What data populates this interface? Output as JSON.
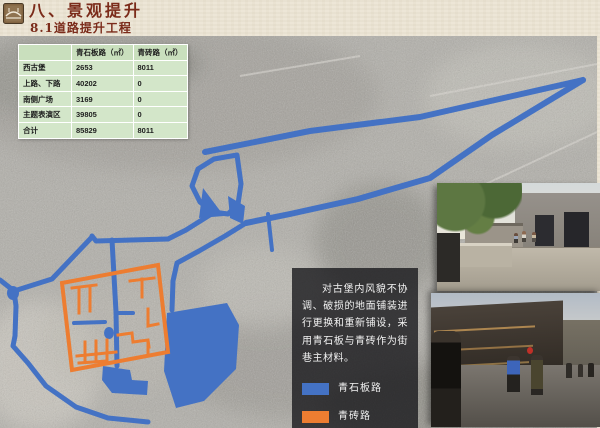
{
  "header": {
    "title": "八、景观提升",
    "subtitle": "8.1道路提升工程"
  },
  "table": {
    "col_headers": [
      "",
      "青石板路（㎡）",
      "青砖路（㎡）"
    ],
    "rows": [
      {
        "label": "西古堡",
        "stone": "2653",
        "brick": "8011"
      },
      {
        "label": "上路、下路",
        "stone": "40202",
        "brick": "0"
      },
      {
        "label": "南侧广场",
        "stone": "3169",
        "brick": "0"
      },
      {
        "label": "主题表演区",
        "stone": "39805",
        "brick": "0"
      },
      {
        "label": "合计",
        "stone": "85829",
        "brick": "8011"
      }
    ]
  },
  "note": {
    "text": "对古堡内风貌不协调、破损的地面铺装进行更换和重新铺设，采用青石板与青砖作为街巷主材料。"
  },
  "legend": {
    "items": [
      {
        "label": "青石板路",
        "color": "#4472C4"
      },
      {
        "label": "青砖路",
        "color": "#ED7D31"
      }
    ]
  },
  "colors": {
    "route_stone_blue": "#4472C4",
    "route_brick_orange": "#ED7D31",
    "title_maroon": "#7B2B1A",
    "table_green": "#D3E6C9",
    "note_box": "rgba(22,22,26,0.78)"
  }
}
